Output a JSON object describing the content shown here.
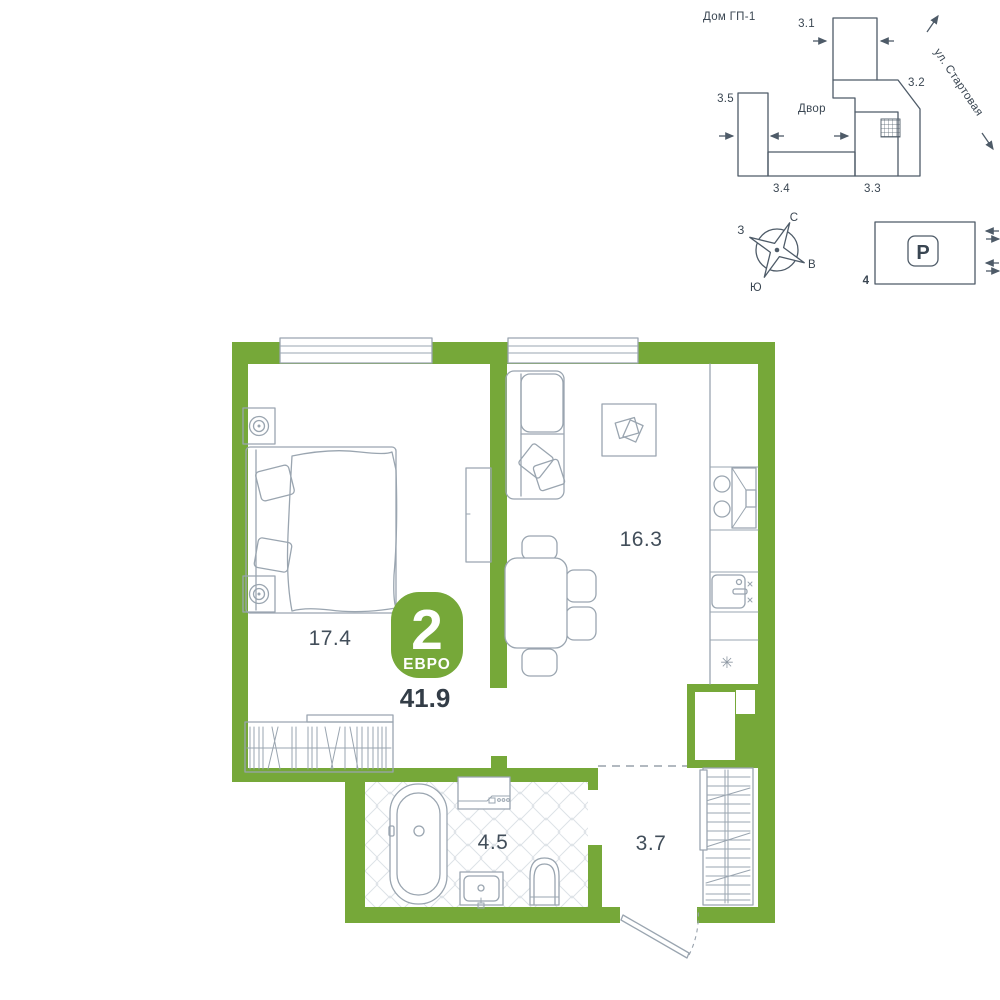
{
  "site_plan": {
    "title": "Дом ГП-1",
    "street_label": "ул. Стартовая",
    "courtyard_label": "Двор",
    "sections": [
      {
        "label": "3.1"
      },
      {
        "label": "3.2"
      },
      {
        "label": "3.3"
      },
      {
        "label": "3.4"
      },
      {
        "label": "3.5"
      }
    ]
  },
  "compass": {
    "north": "С",
    "east": "В",
    "south": "Ю",
    "west": "З"
  },
  "parking": {
    "symbol": "P",
    "lot_label": "4"
  },
  "apartment": {
    "badge": {
      "rooms": "2",
      "type": "ЕВРО"
    },
    "total_area": "41.9",
    "rooms": [
      {
        "name": "bedroom",
        "area": "17.4"
      },
      {
        "name": "kitchen-living-room",
        "area": "16.3"
      },
      {
        "name": "bathroom",
        "area": "4.5"
      },
      {
        "name": "hallway",
        "area": "3.7"
      }
    ],
    "fridge_symbol": "✳"
  },
  "colors": {
    "wall_green": "#76A839",
    "site_outline": "#4E5B68",
    "furniture_gray": "#9AA5B0",
    "text_dark": "#3A4652"
  }
}
